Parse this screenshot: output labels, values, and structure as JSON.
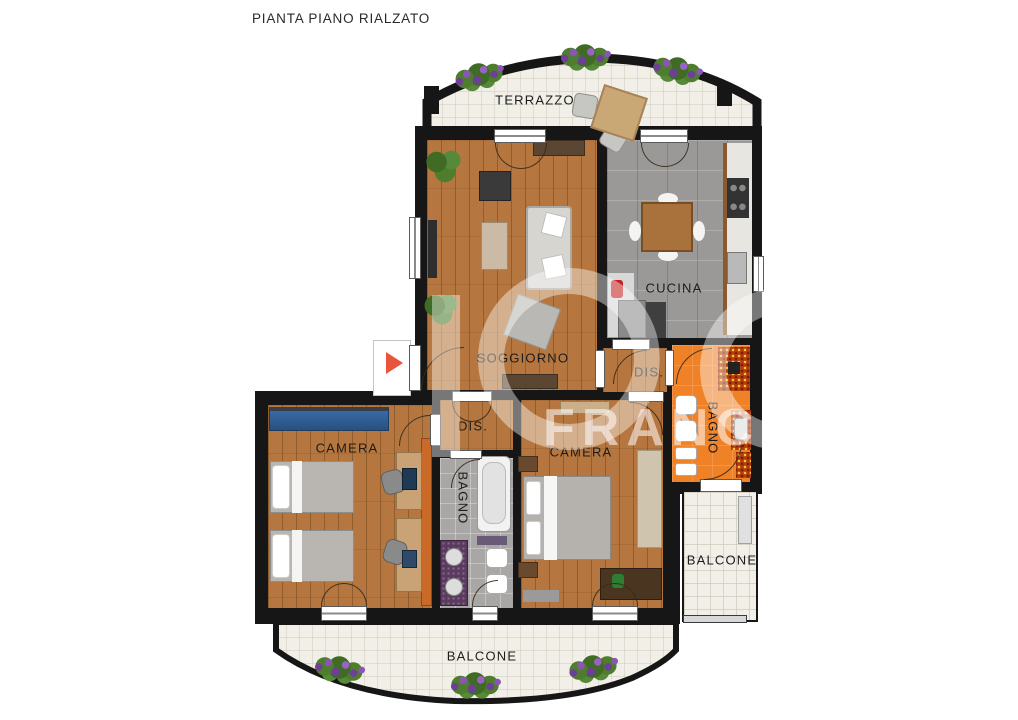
{
  "title": "PIANTA PIANO RIALZATO",
  "watermark": "FRANCH",
  "rooms": {
    "terrazzo": {
      "label": "TERRAZZO"
    },
    "soggiorno": {
      "label": "SOGGIORNO"
    },
    "cucina": {
      "label": "CUCINA"
    },
    "dis_right": {
      "label": "DIS."
    },
    "bagno_right": {
      "label": "BAGNO"
    },
    "dis_middle": {
      "label": "DIS."
    },
    "bagno_middle": {
      "label": "BAGNO"
    },
    "camera_left": {
      "label": "CAMERA"
    },
    "camera_master": {
      "label": "CAMERA"
    },
    "balcone_right": {
      "label": "BALCONE"
    },
    "balcone_bottom": {
      "label": "BALCONE"
    }
  },
  "colors": {
    "wall": "#161616",
    "wood_floor": "#b5773f",
    "kitchen_tile": "#9b9997",
    "bath_orange": "#ef8127",
    "bath_gray": "#a9a7a5",
    "terrace_tile": "#f1efe7",
    "mosaic": "#b33c0c",
    "entrance_arrow": "#e8543c",
    "wardrobe_blue": "#2c5b92",
    "flower_purple": "#6d3f96",
    "plant_green": "#4e7d2e"
  }
}
